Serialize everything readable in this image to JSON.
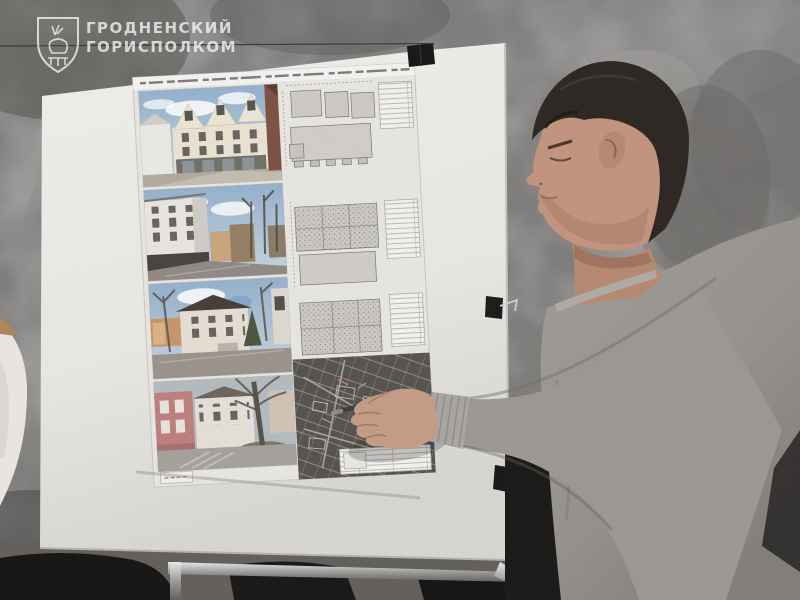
{
  "watermark": {
    "line1": "ГРОДНЕНСКИЙ",
    "line2": "ГОРИСПОЛКОМ"
  },
  "board": {
    "clip_count": 3
  },
  "poster": {
    "photos": [
      "proposed-infill-building-render",
      "street-view-white-corner-house",
      "street-view-plastered-townhouse",
      "street-view-pink-and-white-houses"
    ],
    "floor_plan_sheets": 3,
    "site_plan": "dark-master-plan-with-markups"
  },
  "people": {
    "presenter": "man-in-gray-sweater-pointing-with-pen",
    "bystander": "person-in-white-at-left-edge"
  },
  "colors": {
    "wall": "#7e7c7a",
    "board": "#ebe9e6",
    "poster_paper": "#e7e5e2",
    "site_plan": "#54514d",
    "sweater": "#96938f",
    "hair": "#2b2420",
    "skin": "#c0937d",
    "pink_building": "#bd7e7c",
    "clip": "#161514",
    "watermark_white": "#ffffff"
  }
}
